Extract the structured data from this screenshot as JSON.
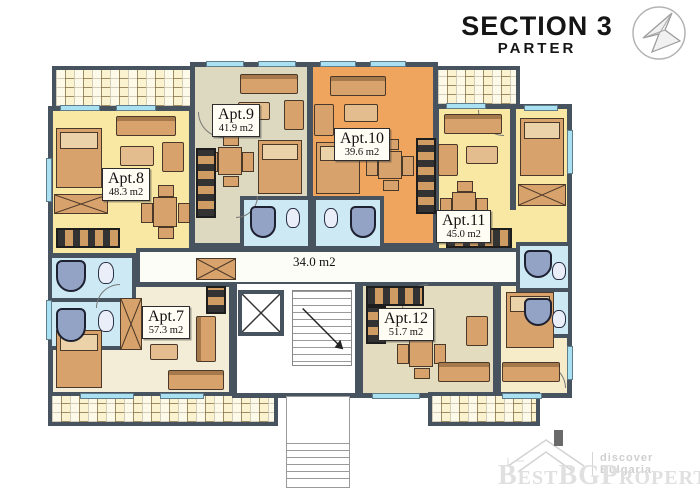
{
  "header": {
    "title": "SECTION 3",
    "subtitle": "PARTER"
  },
  "plan": {
    "corridor_area": "34.0 m2"
  },
  "apartments": [
    {
      "name": "Apt.7",
      "area": "57.3 m2"
    },
    {
      "name": "Apt.8",
      "area": "48.3 m2"
    },
    {
      "name": "Apt.9",
      "area": "41.9 m2"
    },
    {
      "name": "Apt.10",
      "area": "39.6 m2"
    },
    {
      "name": "Apt.11",
      "area": "45.0 m2"
    },
    {
      "name": "Apt.12",
      "area": "51.7 m2"
    }
  ],
  "watermark": {
    "tagline": "discover Bulgaria",
    "brand": "BestBGProperties"
  },
  "icons": {
    "logo": "geometric-compass-logo-icon",
    "house": "house-roof-icon",
    "elevator": "elevator-x-icon",
    "stairs_arrow": "stair-direction-arrow-icon"
  },
  "colors": {
    "wall": "#47545F",
    "room_yellow": "#F8E8A4",
    "room_beige": "#DDD8C0",
    "room_orange": "#F0A55E",
    "room_cream": "#F3ECD6",
    "room_tan": "#E4DCBE",
    "bedroom_pale": "#F6ECCA",
    "bathroom_blue": "#CDE9F4",
    "balcony_cream": "#FBF3D0",
    "furniture_tan": "#D7A26B",
    "window_cyan": "#A9E0F2",
    "watermark_gray": "#E0E0E0"
  }
}
